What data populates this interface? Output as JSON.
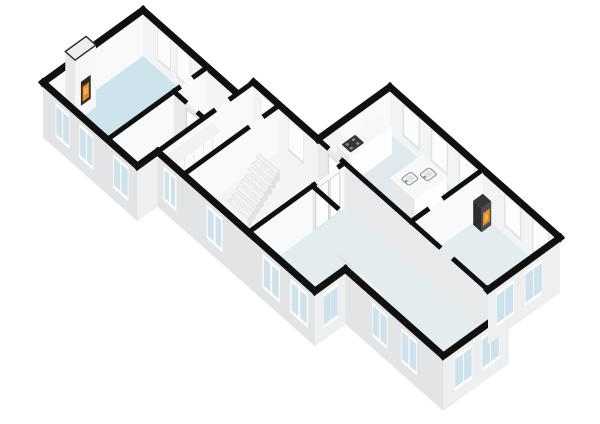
{
  "view": {
    "label": "3D isometric floor plan rendering",
    "background": "#ffffff"
  },
  "palette": {
    "wall_cap": "#101010",
    "face_sw": "#e2e4e6",
    "face_se": "#edeff0",
    "face_lit": "#f8f9fa",
    "face_inner_ne": "#f1f3f4",
    "face_int": "#e7e9eb",
    "floor_living": "#cfe3ec",
    "floor_bath": "#2fa8ce",
    "floor_kitchen": "#e0eaee",
    "floor_room": "#e3ecef",
    "floor_hall": "#f3f4f5",
    "window_frame": "#ffffff",
    "window_glass": "#cfe1ea",
    "slot_frame": "#e2e5e7",
    "slot_glass": "#fbfcfd",
    "fixture_white": "#fcfdfd",
    "fixture_stroke": "#cdd2d5",
    "fire_orange": "#e0882a",
    "fire_amber": "#f2b043",
    "fire_dark": "#33261c",
    "appliance_dark": "#343638",
    "appliance_mid": "#4a4c4e",
    "metal": "#8a9094",
    "step_top": "#f1f2f3",
    "step_side": "#dfe1e3",
    "closet_face": "#fafbfc",
    "seam": "#d7dadc",
    "tub_inner": "#edf1f3"
  },
  "rooms": [
    {
      "id": "living_room",
      "floor": "floor_living"
    },
    {
      "id": "bathroom",
      "floor": "floor_bath"
    },
    {
      "id": "small_hall",
      "floor": "floor_hall"
    },
    {
      "id": "corridor",
      "floor": "floor_hall"
    },
    {
      "id": "hallway",
      "floor": "floor_hall"
    },
    {
      "id": "kitchen",
      "floor": "floor_kitchen"
    },
    {
      "id": "dining_room",
      "floor": "floor_room"
    },
    {
      "id": "side_room",
      "floor": "floor_room"
    },
    {
      "id": "main_room",
      "floor": "floor_room"
    }
  ],
  "fixtures": [
    "fireplace",
    "bathtub",
    "washbasin",
    "wardrobe-closets",
    "staircase",
    "kitchen-counter",
    "tall-cabinet",
    "cooktop",
    "kitchen-island",
    "island-sinks",
    "wood-stove",
    "storage-box",
    "door-panels"
  ]
}
